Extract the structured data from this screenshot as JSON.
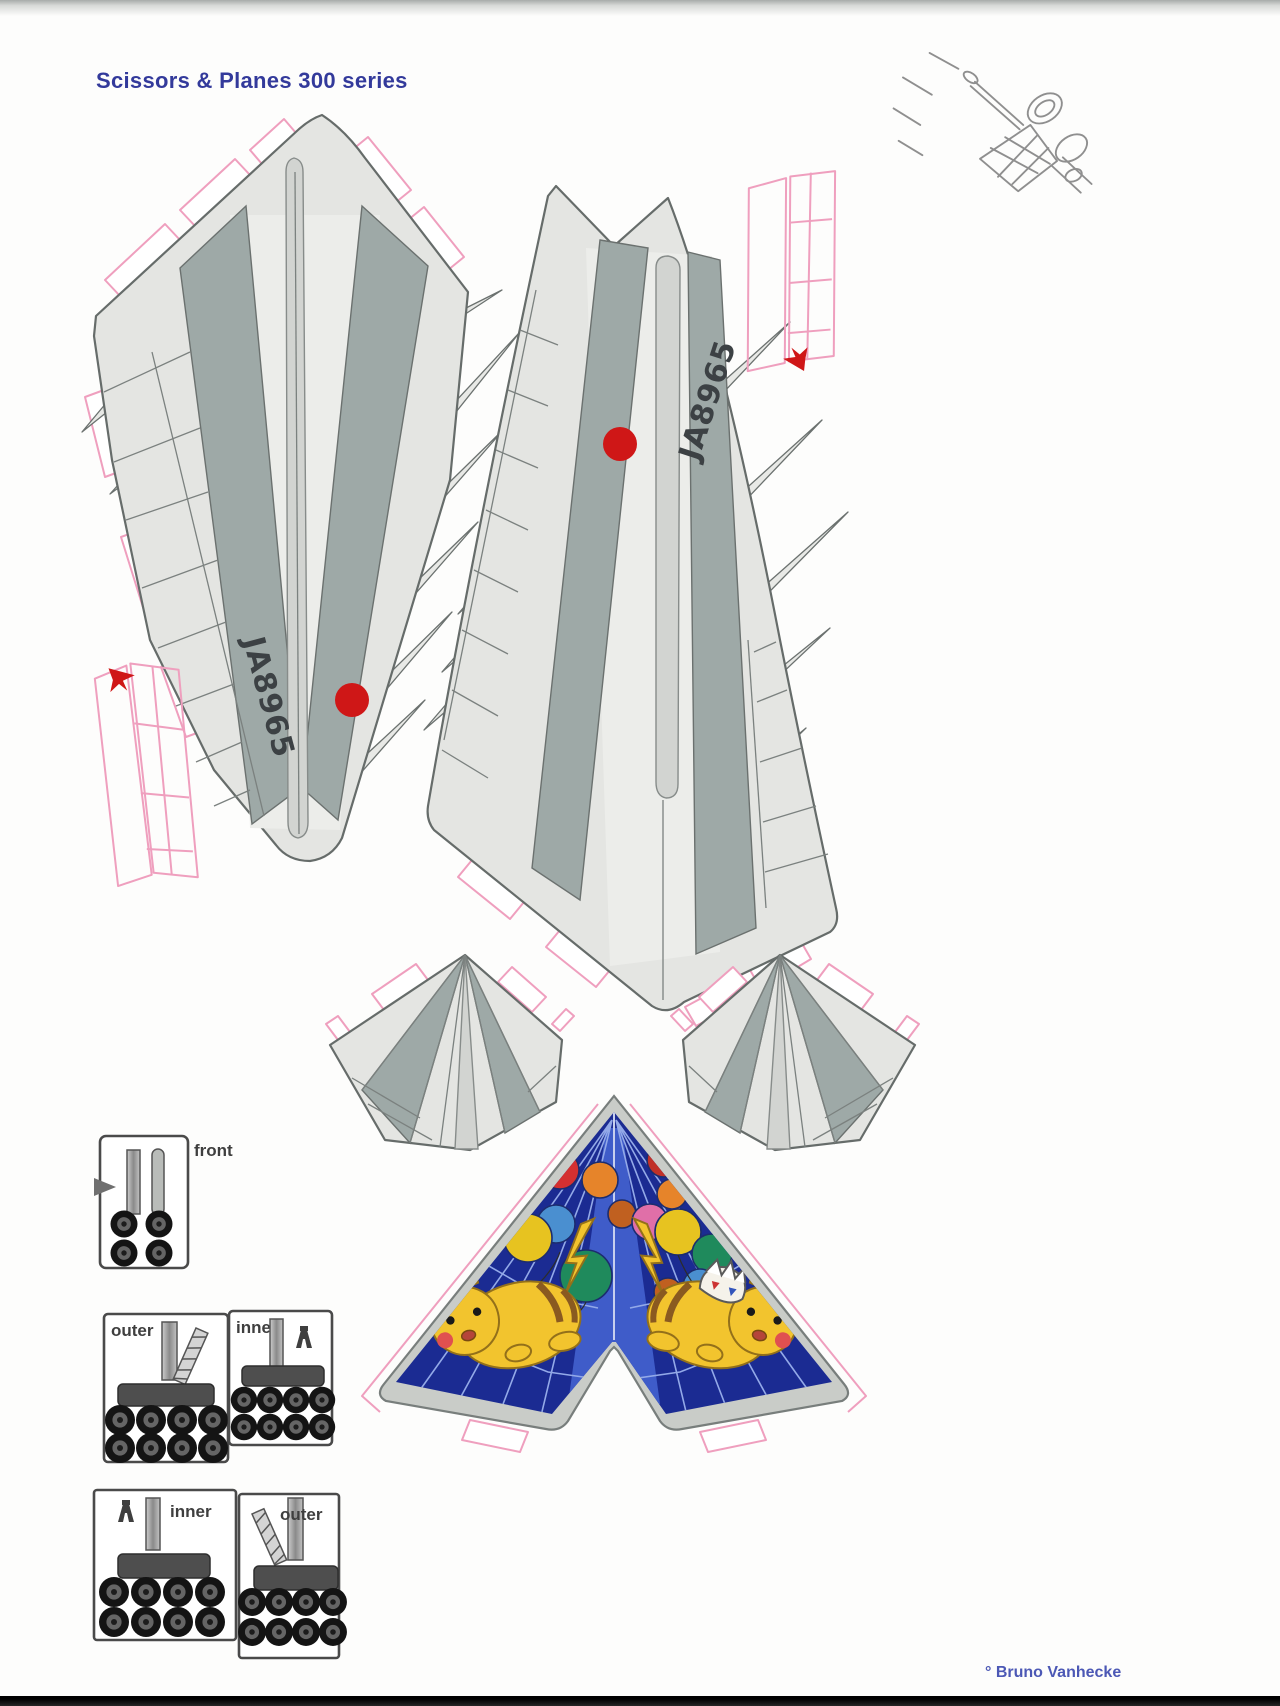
{
  "page": {
    "title": "Scissors & Planes 300 series",
    "credit": "° Bruno Vanhecke"
  },
  "fuselage": {
    "left": {
      "registration": "JA8965",
      "marker": "red-dot"
    },
    "right": {
      "registration": "JA8965",
      "marker": "red-dot"
    }
  },
  "part_boxes": {
    "front": {
      "label": "front",
      "wheel_count": 4
    },
    "outer_top": {
      "label": "outer",
      "wheel_count": 8
    },
    "inner_top": {
      "label": "inner",
      "wheel_count": 8
    },
    "inner_bottom": {
      "label": "inner",
      "wheel_count": 8
    },
    "outer_bottom": {
      "label": "outer",
      "wheel_count": 8
    }
  },
  "markers": {
    "red_dot_count": 2,
    "red_arrow_count": 2
  },
  "artwork": {
    "delta_wing_theme": "Pikachu and Togepi with balloons"
  },
  "colors": {
    "title_text": "#333a9b",
    "credit_text": "#4c58b5",
    "panel_light": "#e4e5e2",
    "panel_shade": "#d2d4d1",
    "panel_sage": "#9ea9a7",
    "outline": "#6b716f",
    "tab_pink": "#ef9fbe",
    "marker_red": "#cf1717",
    "wing_navy": "#1b2b92",
    "wing_blue": "#3f5cc9",
    "wing_grid": "#93a9e8",
    "pikachu_yellow": "#f2c42e",
    "wheel_dark": "#161616"
  }
}
